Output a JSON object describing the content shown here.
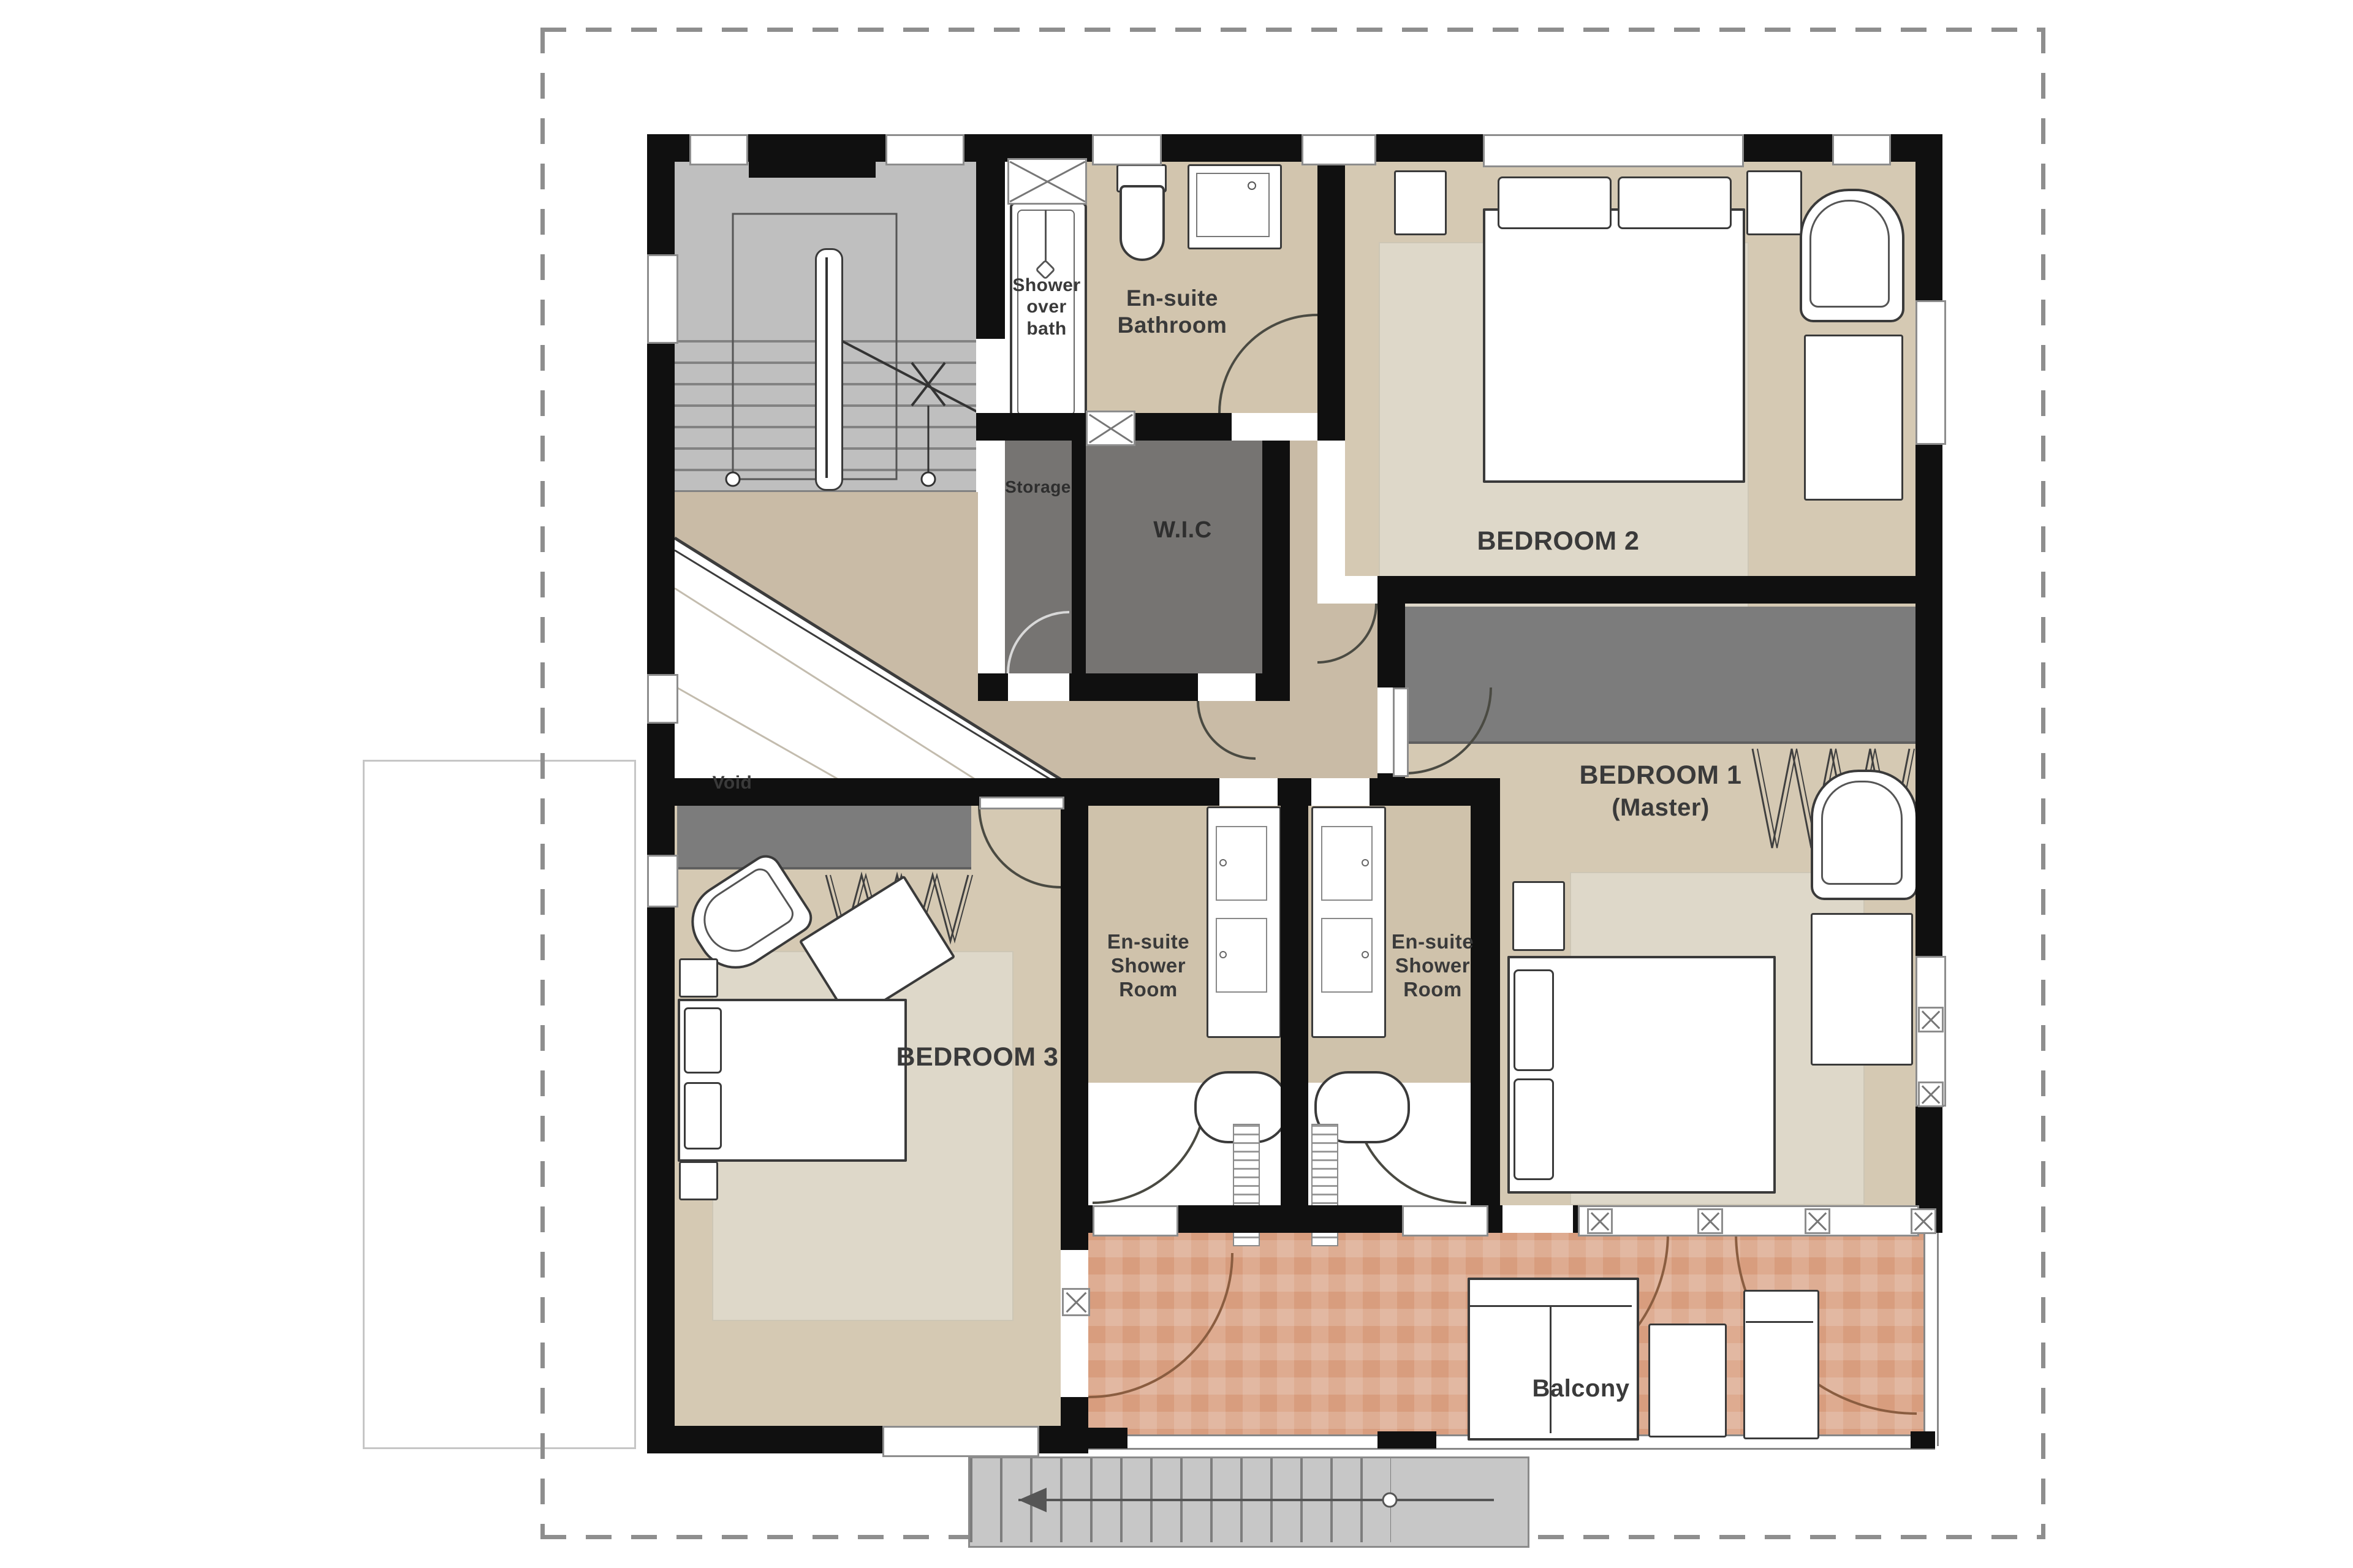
{
  "plan_type": "floor-plan",
  "rooms": {
    "shower_over_bath": {
      "label": "Shower over bath"
    },
    "ensuite_bathroom": {
      "label": "En-suite Bathroom"
    },
    "bedroom_2": {
      "label": "BEDROOM 2"
    },
    "storage": {
      "label": "Storage"
    },
    "wic": {
      "label": "W.I.C"
    },
    "void": {
      "label": "Void"
    },
    "bedroom_1": {
      "label": "BEDROOM 1",
      "sublabel": "(Master)"
    },
    "ensuite_shower_room_left": {
      "label": "En-suite Shower Room"
    },
    "ensuite_shower_room_right": {
      "label": "En-suite Shower Room"
    },
    "bedroom_3": {
      "label": "BEDROOM 3"
    },
    "balcony": {
      "label": "Balcony"
    }
  },
  "colors": {
    "wall": "#101010",
    "room_floor": "#d5c9b3",
    "hall_floor": "#c9bba6",
    "rug": "#ded8c9",
    "storage_gray": "#767472",
    "wardrobe_gray": "#7c7c7c",
    "stair_gray": "#bfbfbf",
    "balcony_terracotta": "#d89d7e",
    "window_frame": "#8d8d8d",
    "label_text": "#3a3a3a",
    "dashed_border": "#8e8e8e"
  }
}
